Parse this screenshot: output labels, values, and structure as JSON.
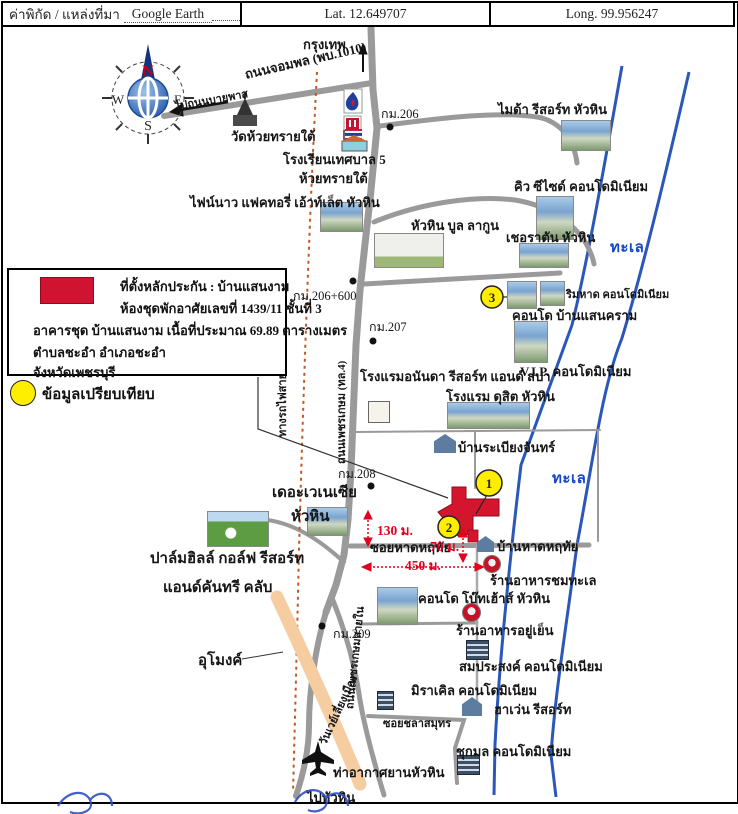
{
  "header": {
    "source_label": "ค่าพิกัด / แหล่งที่มา",
    "source_value": "Google Earth",
    "lat": "Lat.  12.649707",
    "long": "Long.  99.956247"
  },
  "legend": {
    "subject": {
      "line1": "ที่ตั้งหลักประกัน : บ้านแสนงาม",
      "line2": "ห้องชุดพักอาศัยเลขที่ 1439/11 ชั้นที่ 3",
      "line3": "อาคารชุด บ้านแสนงาม เนื้อที่ประมาณ 69.89 ตารางเมตร",
      "line4": "ตำบลชะอำ อำเภอชะอำ",
      "line5": "จังหวัดเพชรบุรี"
    },
    "comparison_label": "ข้อมูลเปรียบเทียบ"
  },
  "compass": {
    "n": "N",
    "e": "E",
    "s": "S",
    "w": "W"
  },
  "markers": [
    {
      "label": "1"
    },
    {
      "label": "2"
    },
    {
      "label": "3"
    }
  ],
  "colors": {
    "road_gray": "#9a9a9a",
    "railway_brown": "#c05a22",
    "bypass_orange": "#f5cda1",
    "coast_blue": "#2a57b8",
    "sea_text_blue": "#1546c8",
    "measure_red": "#e3001d",
    "marker_red": "#d5152e",
    "marker_yellow": "#ffee00"
  },
  "map": {
    "labels": [
      {
        "name": "bangkok-label",
        "text": "กรุงเทพ",
        "x": 303,
        "y": 34
      },
      {
        "name": "road-chomphon-label",
        "text": "ถนนจอมพล (พบ.1010)",
        "x": 245,
        "y": 64,
        "rot": -13
      },
      {
        "name": "to-bypass-label",
        "text": "ไปถนนบายพาส",
        "x": 175,
        "y": 97,
        "rot": -10,
        "cls": "small"
      },
      {
        "name": "km206-label",
        "text": "กม.206",
        "x": 381,
        "y": 104,
        "cls": "km"
      },
      {
        "name": "wat-huai-sai-tai-label",
        "text": "วัดห้วยทรายใต้",
        "x": 231,
        "y": 126
      },
      {
        "name": "school-label-1",
        "text": "โรงเรียนเทศบาล 5",
        "x": 283,
        "y": 149
      },
      {
        "name": "school-label-2",
        "text": "ห้วยทรายใต้",
        "x": 299,
        "y": 168
      },
      {
        "name": "outlet-label",
        "text": "ไฟน์นาว แฟคทอรี่ เอ้าท์เล็ต หัวหิน",
        "x": 190,
        "y": 192
      },
      {
        "name": "mida-label",
        "text": "ไมด้า รีสอร์ท หัวหิน",
        "x": 498,
        "y": 99
      },
      {
        "name": "q-seaside-label",
        "text": "คิว ซีไซด์ คอนโดมิเนียม",
        "x": 514,
        "y": 176
      },
      {
        "name": "blue-lagoon-label",
        "text": "หัวหิน บูล ลากูน",
        "x": 411,
        "y": 215
      },
      {
        "name": "sheraton-label",
        "text": "เชอราตัน หัวหิน",
        "x": 506,
        "y": 227
      },
      {
        "name": "sea-label-1",
        "text": "ทะเล",
        "x": 610,
        "y": 235,
        "cls": "sea"
      },
      {
        "name": "km206-600-label",
        "text": "กม.206+600",
        "x": 293,
        "y": 286,
        "cls": "km"
      },
      {
        "name": "rimhad-label",
        "text": "ริมหาด คอนโดมิเนียม",
        "x": 566,
        "y": 285,
        "cls": "small"
      },
      {
        "name": "baan-saenkram-label",
        "text": "คอนโด บ้านแสนคราม",
        "x": 512,
        "y": 305
      },
      {
        "name": "km207-label",
        "text": "กม.207",
        "x": 369,
        "y": 317,
        "cls": "km"
      },
      {
        "name": "vip-condo-label",
        "text": "V.I.P. คอนโดมิเนียม",
        "x": 520,
        "y": 361
      },
      {
        "name": "ananda-label",
        "text": "โรงแรมอนันดา รีสอร์ท แอนด์ สปา",
        "x": 360,
        "y": 366
      },
      {
        "name": "dusit-label",
        "text": "โรงแรม ดุสิต หัวหิน",
        "x": 446,
        "y": 386
      },
      {
        "name": "railway-label",
        "text": "ทางรถไฟสายใต้",
        "x": 282,
        "y": 428,
        "rot": -90,
        "cls": "small"
      },
      {
        "name": "phetkasem-label",
        "text": "ถนนเพชรเกษม (ทล.4)",
        "x": 341,
        "y": 455,
        "rot": -90,
        "cls": "small"
      },
      {
        "name": "rabiang-chan-label",
        "text": "บ้านระเบียงจันทร์",
        "x": 458,
        "y": 437
      },
      {
        "name": "sea-label-2",
        "text": "ทะเล",
        "x": 552,
        "y": 466,
        "cls": "sea"
      },
      {
        "name": "km208-label",
        "text": "กม.208",
        "x": 338,
        "y": 464,
        "cls": "km"
      },
      {
        "name": "venezia-label-1",
        "text": "เดอะเวเนเซีย",
        "x": 272,
        "y": 480,
        "cls": "big"
      },
      {
        "name": "venezia-label-2",
        "text": "หัวหิน",
        "x": 291,
        "y": 504,
        "cls": "big"
      },
      {
        "name": "m130-label",
        "text": "130 ม.",
        "x": 377,
        "y": 519,
        "cls": "red"
      },
      {
        "name": "soi-hat-haruethai-label",
        "text": "ซอยหาดหฤทัย",
        "x": 370,
        "y": 537
      },
      {
        "name": "m70-label",
        "text": "70 ม.",
        "x": 430,
        "y": 535,
        "cls": "red"
      },
      {
        "name": "baan-hat-haruethai-label",
        "text": "บ้านหาดหฤทัย",
        "x": 497,
        "y": 536
      },
      {
        "name": "m450-label",
        "text": "450 ม.",
        "x": 405,
        "y": 554,
        "cls": "red"
      },
      {
        "name": "chom-talay-label",
        "text": "ร้านอาหารชมทะเล",
        "x": 490,
        "y": 570
      },
      {
        "name": "palm-hills-label-1",
        "text": "ปาล์มฮิลล์ กอล์ฟ รีสอร์ท",
        "x": 150,
        "y": 546,
        "cls": "big"
      },
      {
        "name": "palm-hills-label-2",
        "text": "แอนด์คันทรี คลับ",
        "x": 163,
        "y": 575,
        "cls": "big"
      },
      {
        "name": "boathouse-label",
        "text": "คอนโด โบ๊ทเฮ้าส์ หัวหิน",
        "x": 418,
        "y": 588
      },
      {
        "name": "yu-yen-label",
        "text": "ร้านอาหารอยู่เย็น",
        "x": 456,
        "y": 620
      },
      {
        "name": "km209-label",
        "text": "กม.209",
        "x": 333,
        "y": 624,
        "cls": "km"
      },
      {
        "name": "tunnel-label",
        "text": "อุโมงค์",
        "x": 198,
        "y": 648,
        "cls": "big"
      },
      {
        "name": "somprasong-label",
        "text": "สมประสงค์ คอนโดมิเนียม",
        "x": 459,
        "y": 656
      },
      {
        "name": "miracle-label",
        "text": "มิราเคิล คอนโดมิเนียม",
        "x": 411,
        "y": 680
      },
      {
        "name": "haven-label",
        "text": "ฮาเว่น รีสอร์ท",
        "x": 494,
        "y": 699
      },
      {
        "name": "soi-chala-samut-label",
        "text": "ซอยชลาสมุทร",
        "x": 383,
        "y": 714,
        "cls": "small"
      },
      {
        "name": "chukamol-label",
        "text": "ชุกมล คอนโดมิเนียม",
        "x": 456,
        "y": 741
      },
      {
        "name": "oneway-bypass-label",
        "text": "วันเวย์เลี่ยงเมือง",
        "x": 322,
        "y": 735,
        "rot": -65,
        "cls": "small"
      },
      {
        "name": "phetkasem-inner-label",
        "text": "ถนนเพชรเกษมสายใน",
        "x": 349,
        "y": 700,
        "rot": -84,
        "cls": "small"
      },
      {
        "name": "airport-label",
        "text": "ท่าอากาศยานหัวหิน",
        "x": 333,
        "y": 762
      },
      {
        "name": "to-huahin-label",
        "text": "ไปหัวหิน",
        "x": 307,
        "y": 787
      }
    ],
    "photos": [
      {
        "name": "mida-photo",
        "x": 561,
        "y": 120,
        "w": 50,
        "h": 31,
        "kind": "photo"
      },
      {
        "name": "q-seaside-photo",
        "x": 536,
        "y": 196,
        "w": 38,
        "h": 44,
        "kind": "photo"
      },
      {
        "name": "sheraton-photo",
        "x": 519,
        "y": 243,
        "w": 50,
        "h": 25,
        "kind": "photo"
      },
      {
        "name": "blue-lagoon-sign",
        "x": 374,
        "y": 233,
        "w": 70,
        "h": 35,
        "kind": "sign"
      },
      {
        "name": "rimhad-photo-1",
        "x": 507,
        "y": 281,
        "w": 30,
        "h": 28,
        "kind": "photo"
      },
      {
        "name": "rimhad-photo-2",
        "x": 540,
        "y": 281,
        "w": 25,
        "h": 25,
        "kind": "photo"
      },
      {
        "name": "vip-photo",
        "x": 514,
        "y": 321,
        "w": 34,
        "h": 42,
        "kind": "photo"
      },
      {
        "name": "outlet-photo",
        "x": 320,
        "y": 202,
        "w": 43,
        "h": 30,
        "kind": "photo"
      },
      {
        "name": "dusit-photo",
        "x": 447,
        "y": 402,
        "w": 83,
        "h": 27,
        "kind": "photo"
      },
      {
        "name": "ananda-logo",
        "x": 368,
        "y": 401,
        "w": 22,
        "h": 22,
        "kind": "box"
      },
      {
        "name": "venezia-photo",
        "x": 307,
        "y": 507,
        "w": 41,
        "h": 29,
        "kind": "photo"
      },
      {
        "name": "golf-photo",
        "x": 207,
        "y": 511,
        "w": 62,
        "h": 36,
        "kind": "photo-green"
      },
      {
        "name": "boathouse-photo",
        "x": 377,
        "y": 587,
        "w": 41,
        "h": 38,
        "kind": "photo"
      },
      {
        "name": "chom-talay-icon",
        "x": 483,
        "y": 555,
        "w": 18,
        "h": 18,
        "kind": "redcircle"
      },
      {
        "name": "yu-yen-icon",
        "x": 462,
        "y": 603,
        "w": 19,
        "h": 19,
        "kind": "redcircle"
      },
      {
        "name": "somprasong-icon",
        "x": 466,
        "y": 640,
        "w": 23,
        "h": 20,
        "kind": "bldg"
      },
      {
        "name": "miracle-icon",
        "x": 377,
        "y": 691,
        "w": 17,
        "h": 19,
        "kind": "bldg"
      },
      {
        "name": "haven-icon",
        "x": 462,
        "y": 697,
        "w": 20,
        "h": 19,
        "kind": "house"
      },
      {
        "name": "chukamol-icon",
        "x": 457,
        "y": 755,
        "w": 23,
        "h": 20,
        "kind": "bldg"
      },
      {
        "name": "baan-hat-icon",
        "x": 477,
        "y": 536,
        "w": 17,
        "h": 16,
        "kind": "house"
      },
      {
        "name": "rabiang-chan-icon",
        "x": 434,
        "y": 434,
        "w": 22,
        "h": 19,
        "kind": "house"
      }
    ]
  }
}
